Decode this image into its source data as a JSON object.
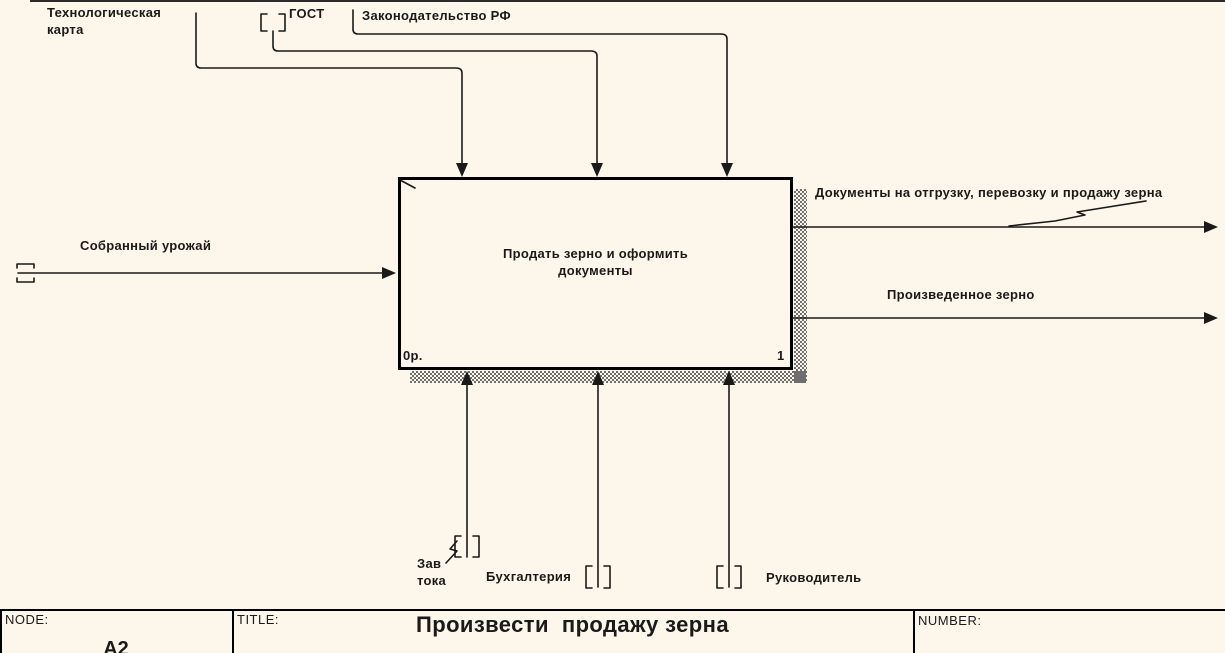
{
  "diagram": {
    "controls": [
      {
        "label": "Технологическая карта"
      },
      {
        "label": "ГОСТ"
      },
      {
        "label": "Законодательство РФ"
      }
    ],
    "inputs": [
      {
        "label": "Собранный урожай"
      }
    ],
    "outputs": [
      {
        "label": "Документы на отгрузку, перевозку и продажу зерна"
      },
      {
        "label": "Произведенное зерно"
      }
    ],
    "mechanisms": [
      {
        "label": "Зав тока"
      },
      {
        "label": "Бухгалтерия"
      },
      {
        "label": "Руководитель"
      }
    ],
    "activity": {
      "name": "Продать зерно и оформить документы",
      "cost": "0р.",
      "number": "1"
    }
  },
  "footer": {
    "node_label": "NODE:",
    "node_value": "A2",
    "title_label": "TITLE:",
    "title_value": "Произвести  продажу зерна",
    "number_label": "NUMBER:",
    "number_value": ""
  },
  "colors": {
    "background": "#fcf6eb",
    "line": "#1a1a1a"
  }
}
